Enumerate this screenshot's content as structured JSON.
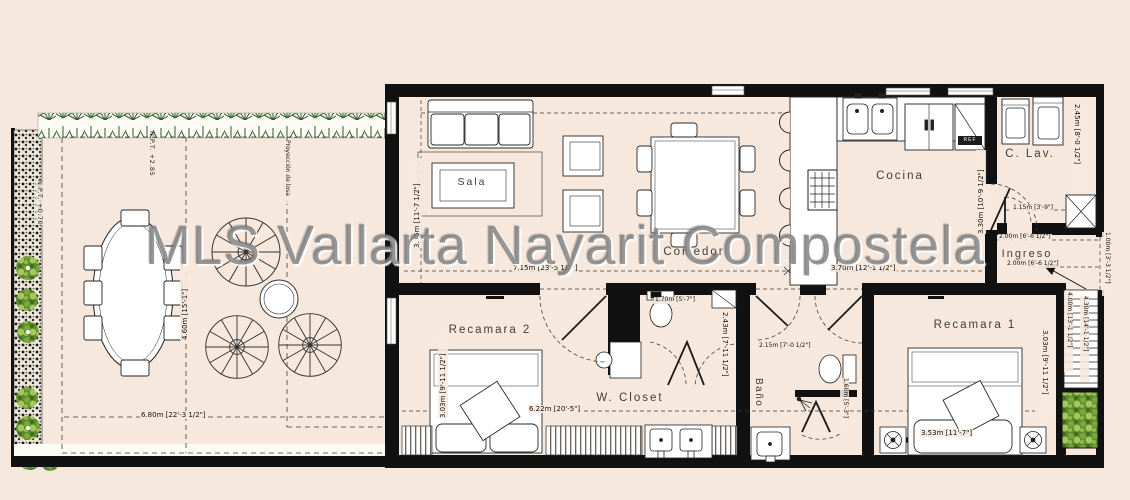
{
  "watermark": "MLS Vallarta Nayarit Compostela",
  "colors": {
    "background": "#f7e8dd",
    "wall": "#111111",
    "hedge_green": "#41702e",
    "garden_green": "#6f9c33"
  },
  "labels": {
    "sala": "Sala",
    "comedor": "Comedor",
    "cocina": "Cocina",
    "c_lav": "C. Lav.",
    "ingreso": "Ingreso",
    "recamara1": "Recamara 1",
    "recamara2": "Recamara 2",
    "w_closet": "W. Closet",
    "bano": "Baño",
    "ref": "REF"
  },
  "levels": {
    "terrace": "N.P.T. +2.85",
    "garden": "N.P.T. +0.70"
  },
  "notes": {
    "slab_projection": "Proyección de losa"
  },
  "dimensions": {
    "terrace_width": "6.80m [22'-3 1/2\"]",
    "terrace_depth": "4.60m [15'-1\"]",
    "living_width": "7.15m [23'-5 1/2\"]",
    "living_depth": "3.55m [11'-7 1/2\"]",
    "kitchen_width": "3.70m [12'-1 1/2\"]",
    "kitchen_depth": "3.30m [10'-9 1/2\"]",
    "laundry_depth": "2.45m [8'-0 1/2\"]",
    "laundry_door": "1.15m [3'-9\"]",
    "entry_width_a": "2.00m [6'-6 1/2\"]",
    "entry_width_b": "2.00m [6'-6 1/2\"]",
    "entry_side": "1.00m [3'-3 1/2\"]",
    "bedroom2_depth": "3.03m [9'-11 1/2\"]",
    "closet_run": "6.22m [20'-5\"]",
    "wc_width": "1.70m [5'-7\"]",
    "wc_depth": "2.43m [7'-11 1/2\"]",
    "bath_width": "2.15m [7'-0 1/2\"]",
    "bath_depth": "1.60m [5'-3\"]",
    "bedroom1_width": "3.53m [11'-7\"]",
    "bedroom1_depth": "3.03m [9'-11 1/2\"]",
    "stair_a": "4.00m [13'-1 1/2\"]",
    "stair_b": "4.30m [14'-1 1/2\"]"
  }
}
